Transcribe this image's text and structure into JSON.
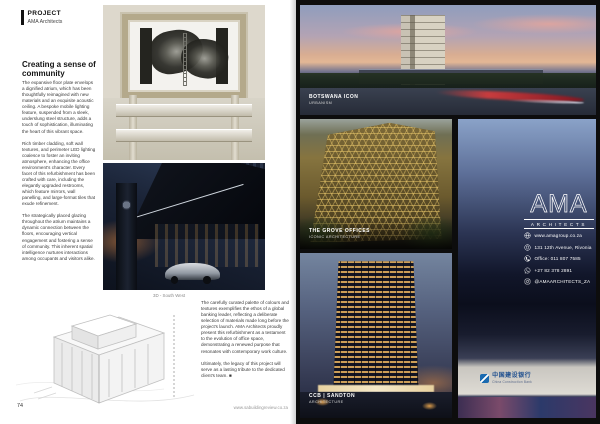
{
  "magazine": {
    "left_page": {
      "kicker": "PROJECT",
      "kicker_sub": "AMA Architects",
      "heading": "Creating a sense of community",
      "col1": [
        "The expansive floor plate envelops a dignified atrium, which has been thoughtfully reimagined with new materials and an exquisite acoustic ceiling. A bespoke mobile lighting feature, suspended from a sleek, underslung steel structure, adds a touch of sophistication, illuminating the heart of this vibrant space.",
        "Rich timber cladding, soft wall textures, and perimeter LED lighting coalesce to foster an inviting atmosphere, enhancing the office environment's character. Every facet of this refurbishment has been crafted with care, including the elegantly upgraded restrooms, which feature mirrors, wall panelling, and large-format tiles that exude refinement.",
        "The strategically placed glazing throughout the atrium maintains a dynamic connection between the floors, encouraging vertical engagement and fostering a sense of community. This inherent spatial intelligence nurtures interactions among occupants and visitors alike."
      ],
      "drawing_caption": "3D - South West",
      "col2": [
        "The carefully curated palette of colours and textures exemplifies the ethos of a global banking leader, reflecting a deliberate selection of materials made long before the project's launch. AMA Architects proudly present this refurbishment as a testament to the evolution of office space, demonstrating a renewed purpose that resonates with contemporary work culture.",
        "Ultimately, the legacy of this project will serve as a lasting tribute to the dedicated client's team. ■"
      ],
      "page_number": "74",
      "website": "www.sabuildingreview.co.za"
    },
    "right_page": {
      "images": [
        {
          "title": "BOTSWANA ICON",
          "subtitle": "URBANISM"
        },
        {
          "title": "THE GROVE OFFICES",
          "subtitle": "ICONIC ARCHITECTURE"
        },
        {
          "title": "CCB | SANDTON",
          "subtitle": "ARCHITECTURE"
        }
      ],
      "logo": {
        "word": "AMA",
        "subword": "ARCHITECTS"
      },
      "contacts": [
        {
          "icon": "globe-icon",
          "text": "www.amagroup.co.za"
        },
        {
          "icon": "location-pin-icon",
          "text": "131 12th Avenue, Rivonia"
        },
        {
          "icon": "phone-icon",
          "text": "Office: 011 807 7585"
        },
        {
          "icon": "whatsapp-icon",
          "text": "+27 82 378 2891"
        },
        {
          "icon": "instagram-icon",
          "text": "@AMAARCHITECTS_ZA"
        }
      ],
      "ccb_sign": {
        "cn": "中国建设银行",
        "en": "China Construction Bank"
      }
    },
    "colors": {
      "page_dark": "#0d0d0d",
      "facade_gold": "#e8c96e",
      "ccb_blue": "#1a6ab0"
    }
  }
}
